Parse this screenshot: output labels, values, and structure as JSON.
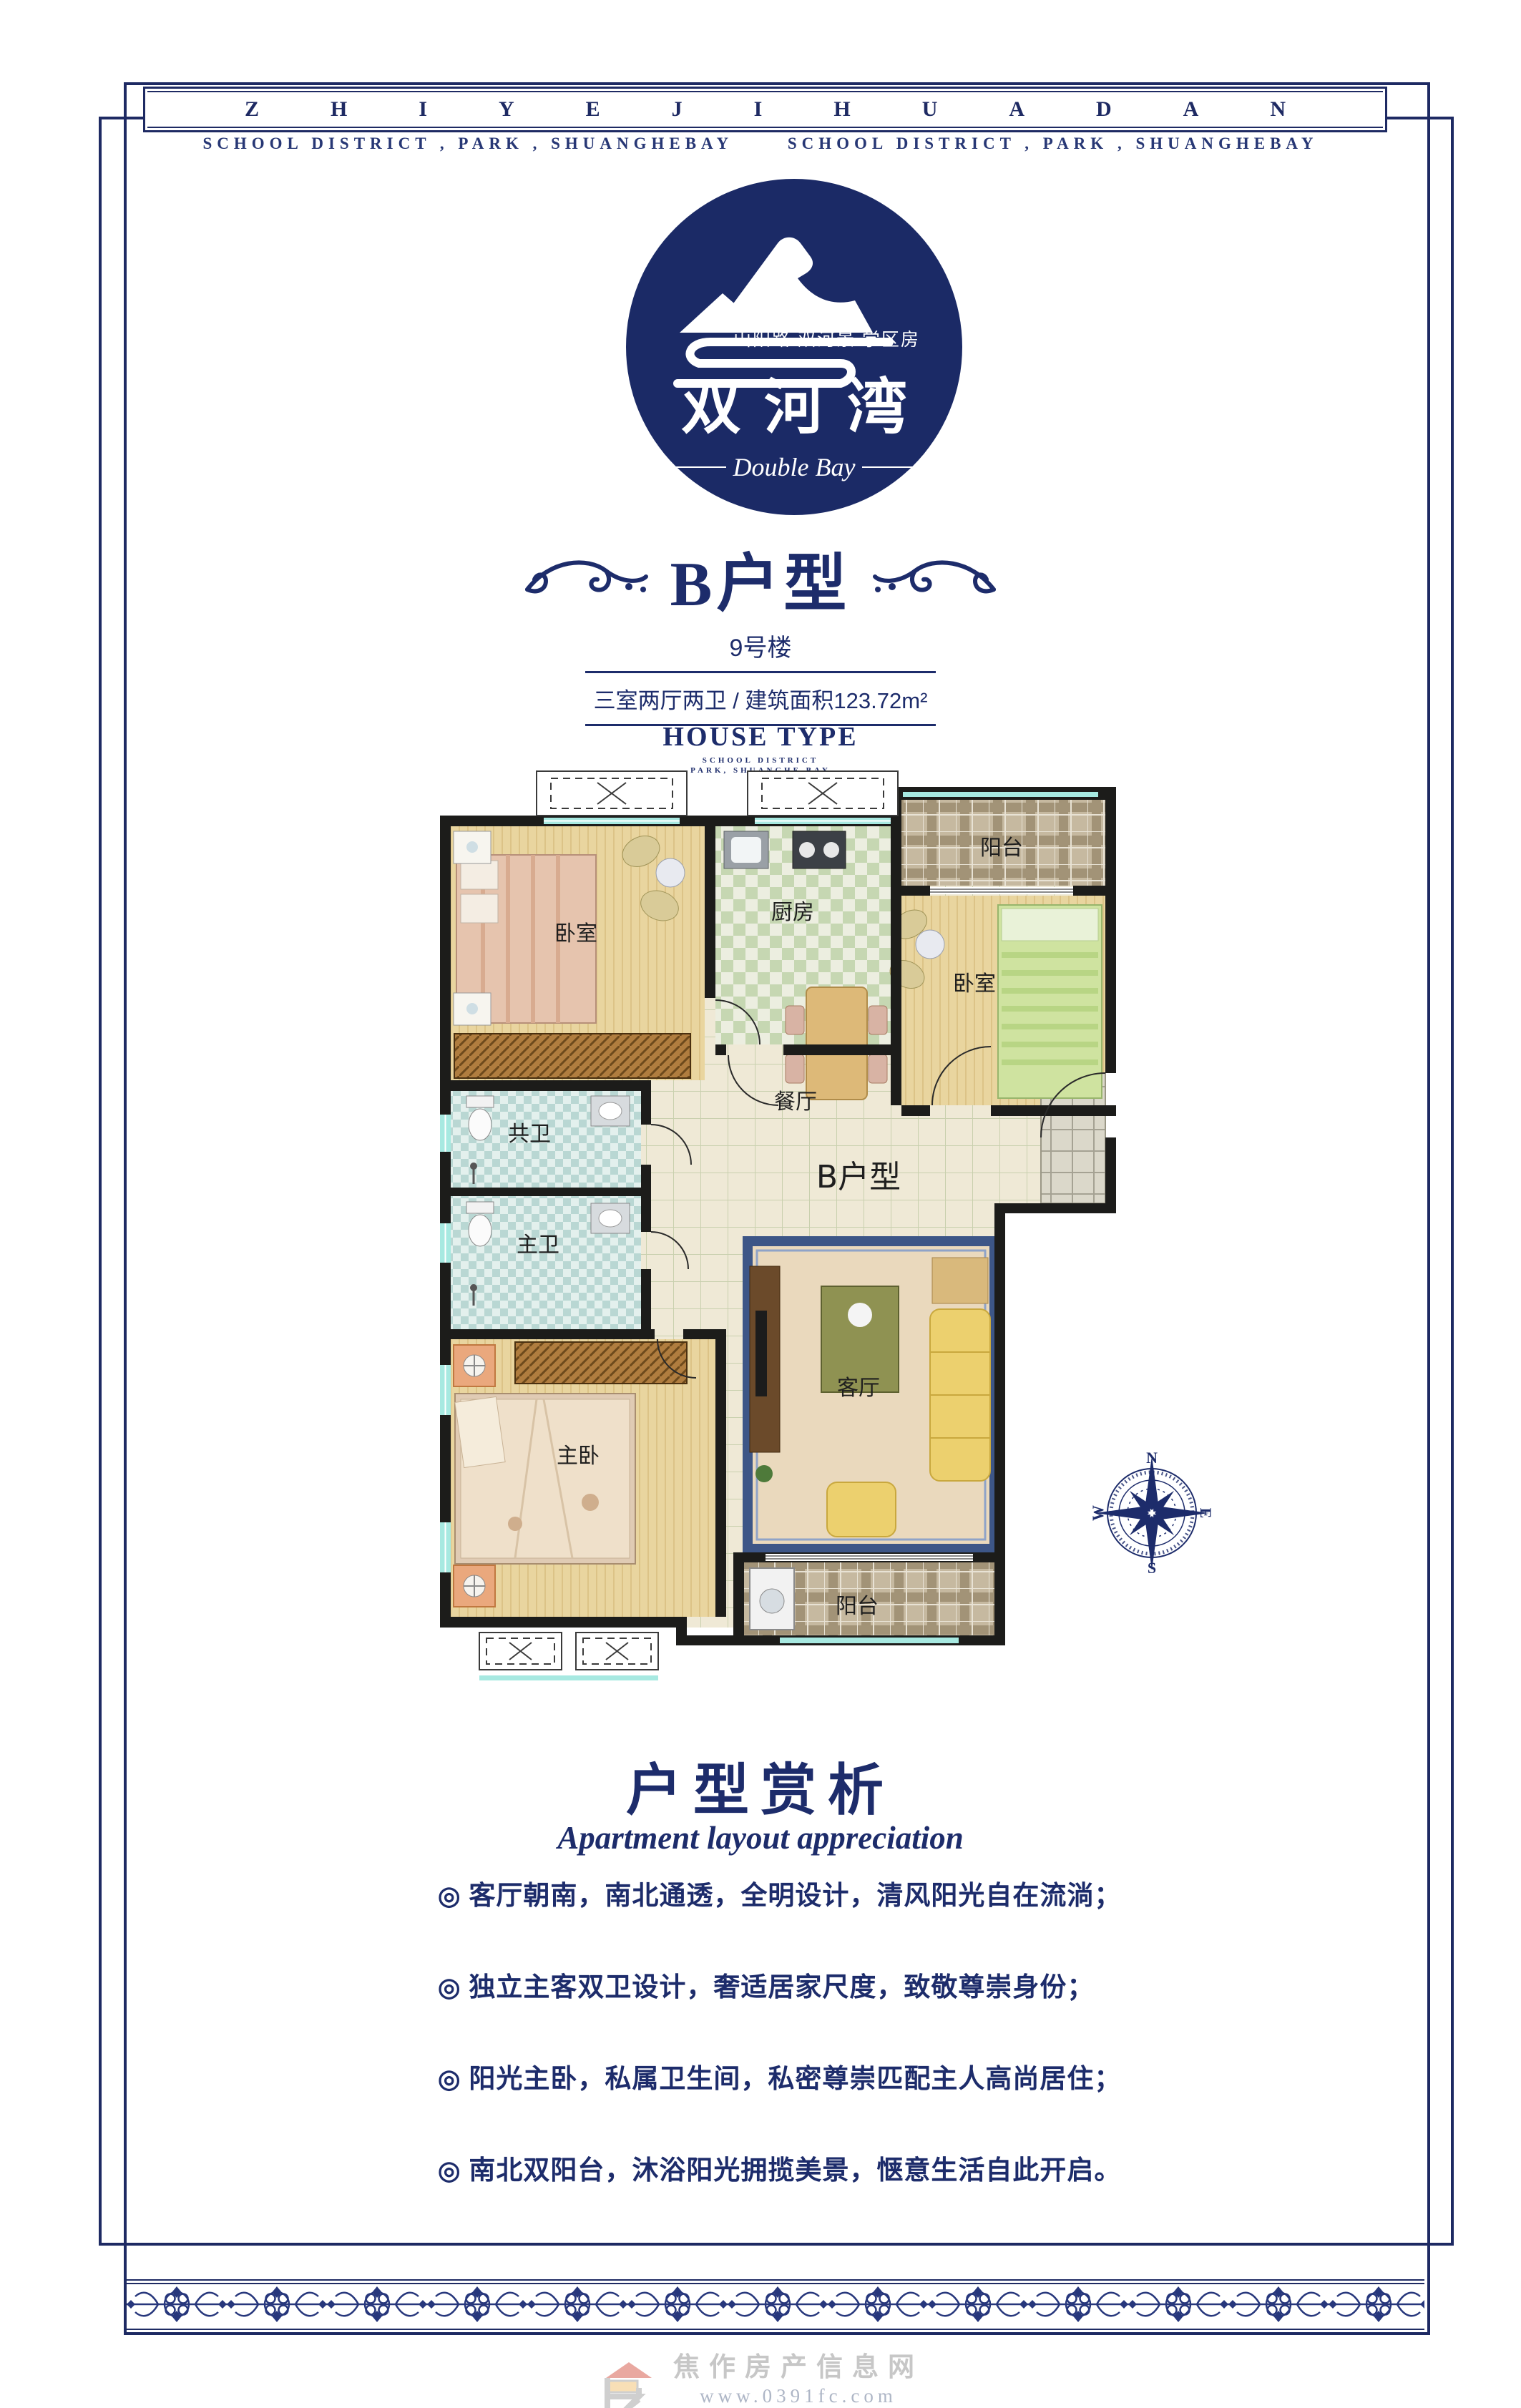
{
  "band": {
    "letters": "ZHIYEJIHUADAN",
    "subtitle": "SCHOOL DISTRICT , PARK , SHUANGHEBAY      SCHOOL DISTRICT , PARK , SHUANGHEBAY"
  },
  "logo": {
    "tagline": "山阳路 双河景 学区房",
    "name": "双河湾",
    "name_en": "Double Bay"
  },
  "unit": {
    "title": "B户型",
    "building": "9号楼",
    "spec": "三室两厅两卫 / 建筑面积123.72m²",
    "house_type": "HOUSE TYPE",
    "house_type_sub1": "SCHOOL DISTRICT",
    "house_type_sub2": "PARK, SHUANGHE BAY"
  },
  "plan": {
    "labels": {
      "bedroom_tl": "卧室",
      "kitchen": "厨房",
      "balcony_top": "阳台",
      "bedroom_r": "卧室",
      "dining": "餐厅",
      "unit": "B户型",
      "bath_shared": "共卫",
      "bath_master": "主卫",
      "master": "主卧",
      "living": "客厅",
      "balcony_bottom": "阳台"
    },
    "compass": {
      "n": "N",
      "e": "E",
      "s": "S",
      "w": "W"
    }
  },
  "analysis": {
    "title": "户型赏析",
    "subtitle": "Apartment layout appreciation",
    "bullet_marker": "◎",
    "bullets": [
      "客厅朝南，南北通透，全明设计，清风阳光自在流淌；",
      "独立主客双卫设计，奢适居家尺度，致敬尊崇身份；",
      "阳光主卧，私属卫生间，私密尊崇匹配主人高尚居住；",
      "南北双阳台，沐浴阳光拥揽美景，惬意生活自此开启。"
    ]
  },
  "footer": {
    "site_name": "焦作房产信息网",
    "site_url": "www.0391fc.com",
    "site_slogan": "焦作房地产门户"
  },
  "colors": {
    "navy": "#1d2c6b",
    "logo_circle": "#1b2a66",
    "window_cyan": "#a7e9e1"
  }
}
